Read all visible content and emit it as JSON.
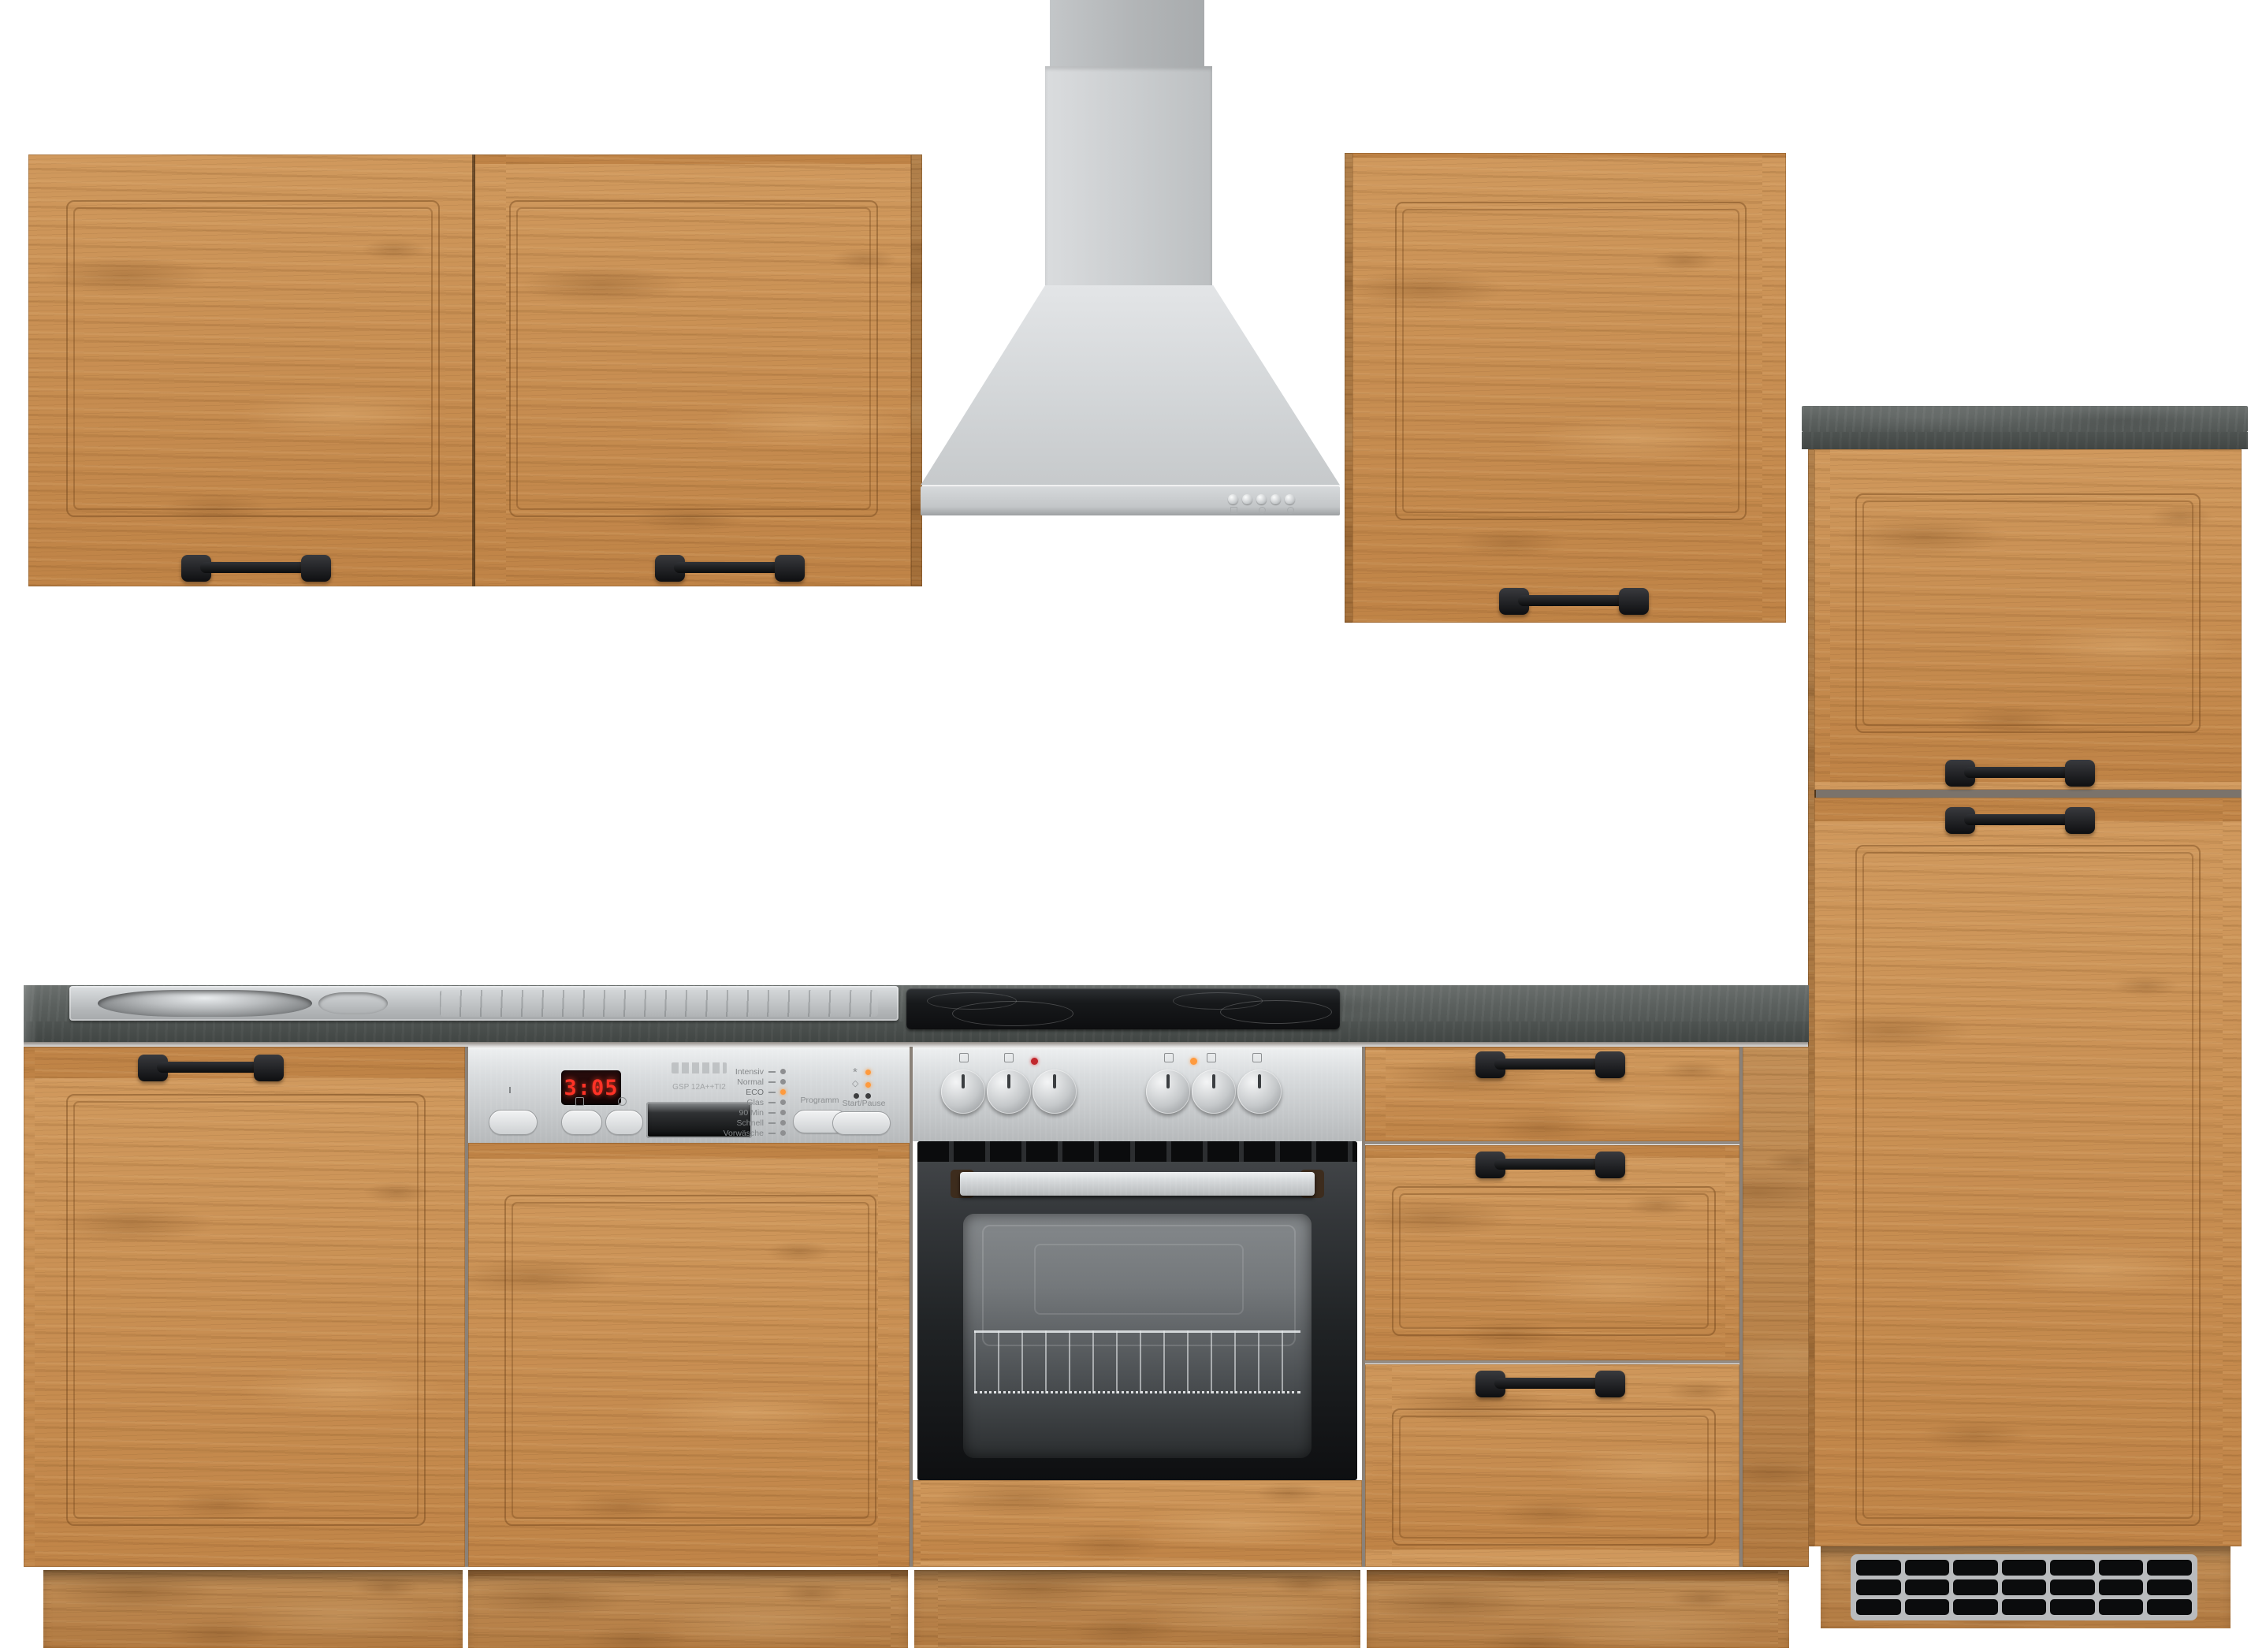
{
  "image_type": "product-photo",
  "subject": "oak kitchen cabinet set with stainless appliances on white background",
  "palette": {
    "background": "#ffffff",
    "wood": "#c78c4d",
    "wood_dark_edge": "#9e6d38",
    "worktop_slate": "#565b59",
    "stainless": "#cdd0d2",
    "oven_black": "#1b1d1f",
    "handle_black": "#151618",
    "led_red": "#ff3226",
    "led_orange": "#ff9a3d",
    "grille_black": "#0c0d0e"
  },
  "hood": {
    "button_count": 5
  },
  "dishwasher": {
    "display_time": "3:05",
    "model_text": "GSP 12A++TI2",
    "programs": [
      "Intensiv",
      "Normal",
      "ECO",
      "Glas",
      "90 Min",
      "Schnell",
      "Vorwäsche"
    ],
    "active_program": "ECO",
    "program_button_label": "Programm",
    "start_button_label": "Start/Pause"
  },
  "oven": {
    "knob_count": 6
  },
  "tall_cabinet": {
    "grille_rows": 3,
    "grille_columns": 7
  },
  "icons": {
    "salt_indicator": "*",
    "rinse_aid_indicator": "◇"
  }
}
